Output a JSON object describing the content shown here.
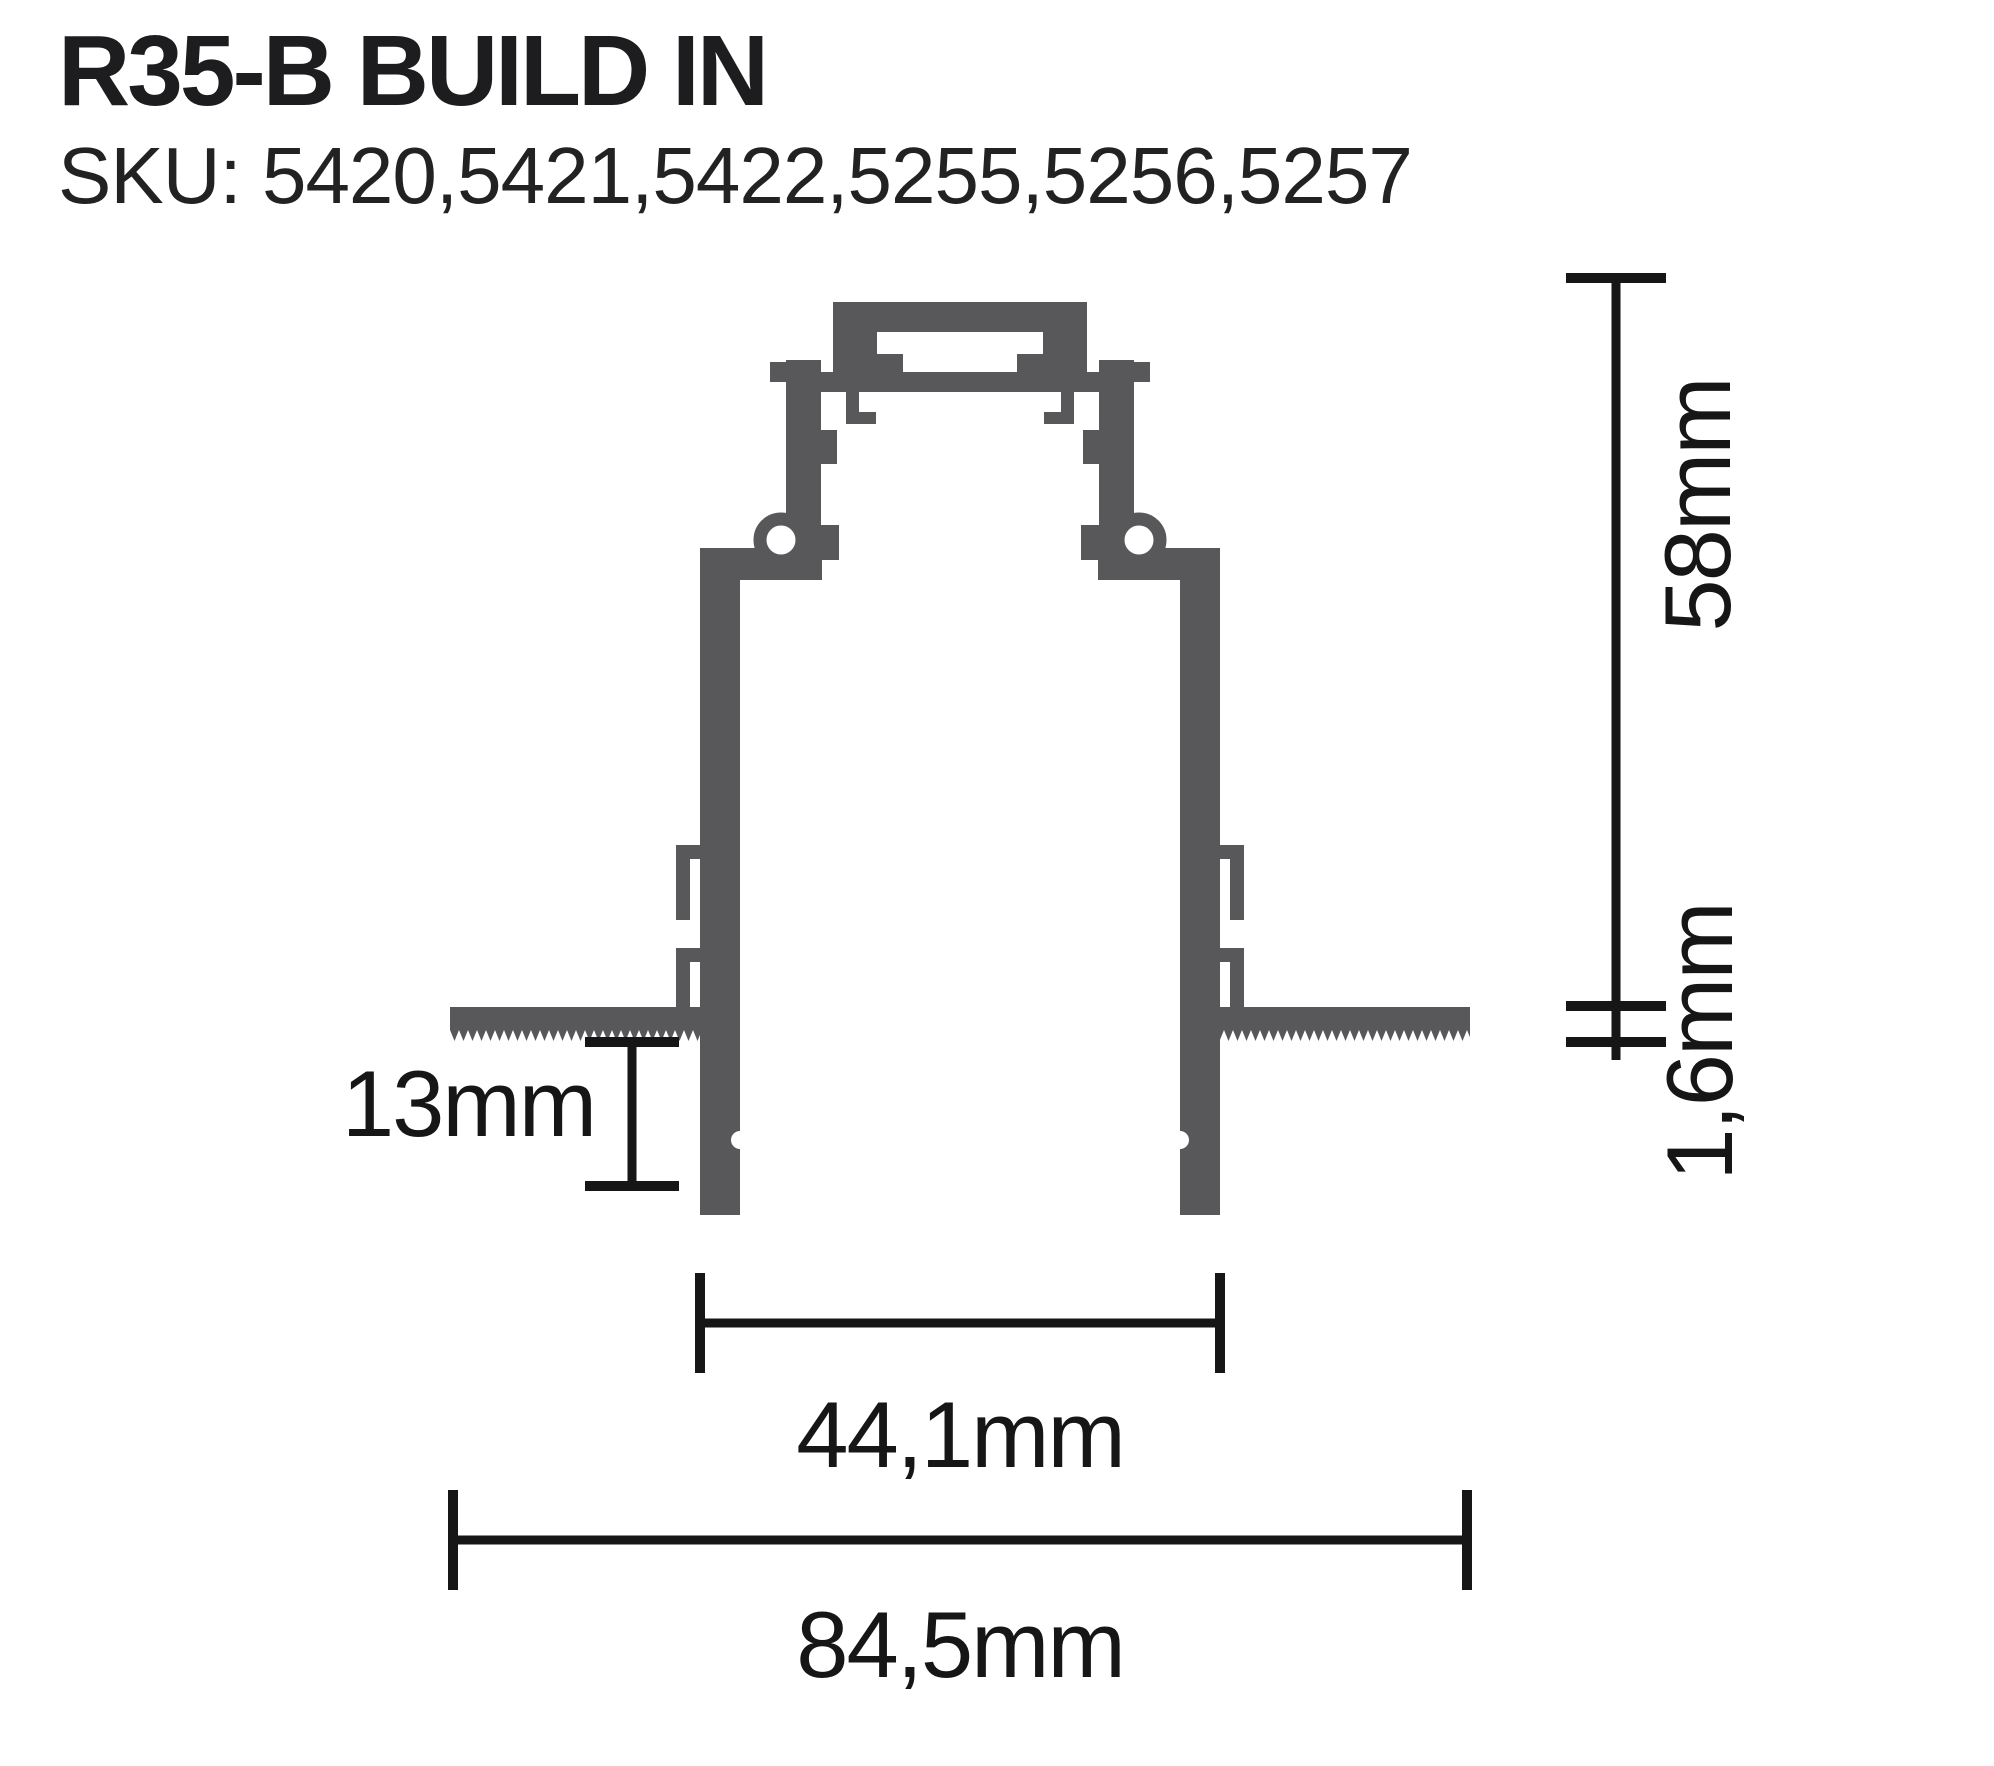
{
  "page": {
    "title": "R35-B BUILD IN",
    "sku_line": "SKU: 5420,5421,5422,5255,5256,5257"
  },
  "diagram": {
    "kind": "profile-cross-section",
    "dimensions": [
      {
        "id": "overall-height",
        "label": "58mm",
        "orientation": "vertical"
      },
      {
        "id": "flange-thickness",
        "label": "1,6mm",
        "orientation": "vertical"
      },
      {
        "id": "recess-depth",
        "label": "13mm",
        "orientation": "horizontal"
      },
      {
        "id": "body-width",
        "label": "44,1mm",
        "orientation": "horizontal"
      },
      {
        "id": "flange-width",
        "label": "84,5mm",
        "orientation": "horizontal"
      }
    ],
    "colors": {
      "profile_gray": "#58585a",
      "dimension_black": "#161616",
      "background": "#ffffff"
    }
  }
}
